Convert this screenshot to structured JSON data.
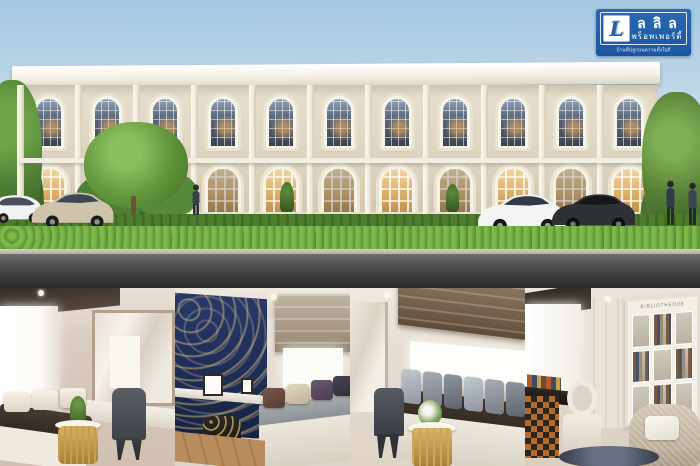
{
  "brand": {
    "monogram": "L",
    "name_top": "ลลิล",
    "name_bottom": "พร็อพเพอร์ตี้",
    "tagline": "บ้านที่ปลูกบนความตั้งใจดี",
    "box_color": "#1b55a0",
    "text_color": "#ffffff"
  },
  "exterior": {
    "description_tags": [
      "two-storey-townhome-render",
      "arched-windows",
      "hedge",
      "road"
    ],
    "bay_count": 11,
    "palette": {
      "sky_top": "#a5c8e1",
      "facade": "#ddd3bf",
      "trim": "#f4f0e6",
      "hedge": "#559029",
      "road": "#3a3c3e",
      "driveway": "#b28877"
    },
    "vehicles": [
      "white-suv",
      "champagne-sedan",
      "white-sedan",
      "black-sedan"
    ],
    "people_count": 3
  },
  "interiors": {
    "panel_count": 4,
    "panels": [
      {
        "name": "vanity-dressing-room"
      },
      {
        "name": "navy-wallpaper-study-nook"
      },
      {
        "name": "window-seat-lounge"
      },
      {
        "name": "library-study",
        "bookcase_label": "BIBLIOTHEQUE"
      }
    ],
    "lounge_pillow_count": 6,
    "nook_pillow_colors": [
      "#6b4a3e",
      "#d8cdb6",
      "#5c4a5e",
      "#3f3a45"
    ]
  }
}
